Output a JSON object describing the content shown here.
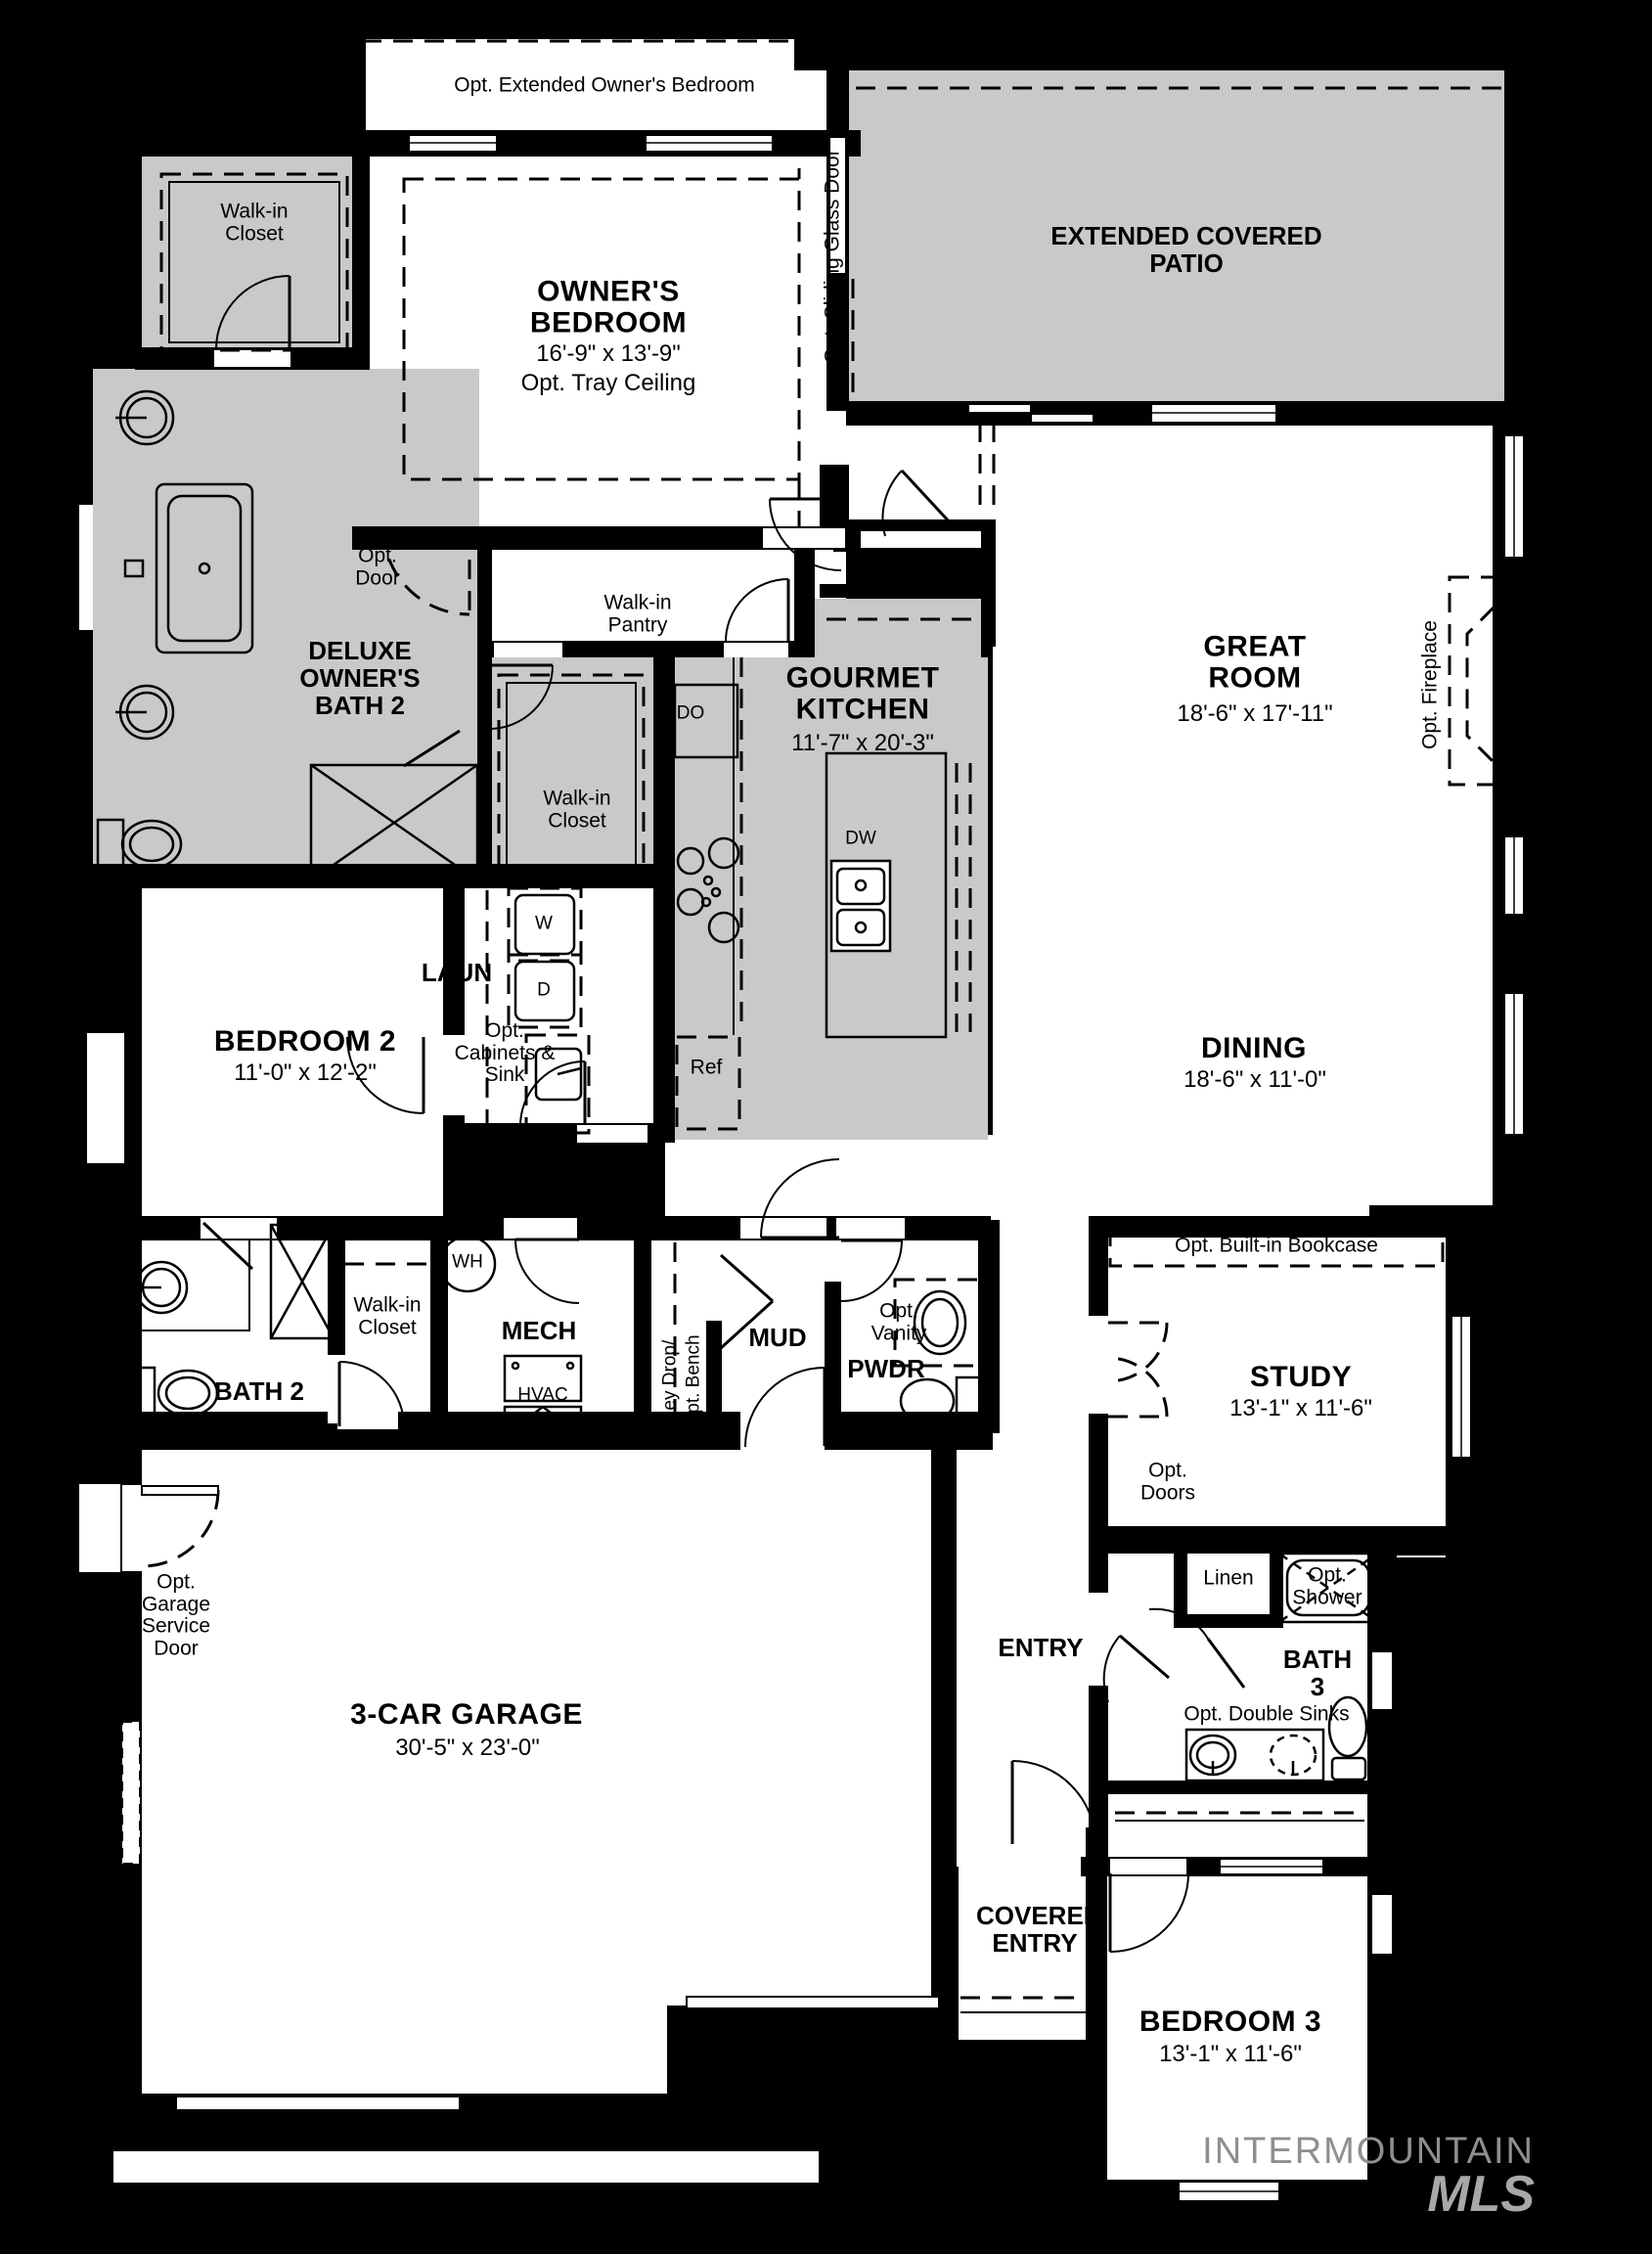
{
  "colors": {
    "background": "#000000",
    "floor": "#ffffff",
    "shaded": "#c9c9c9",
    "wall": "#000000",
    "watermark_gray": "#9b9b9b"
  },
  "rooms": {
    "opt_extended_owners_bedroom": {
      "label": "Opt. Extended Owner's Bedroom"
    },
    "walk_in_closet_owner": {
      "label": "Walk-in Closet"
    },
    "owners_bedroom": {
      "name": "OWNER'S BEDROOM",
      "dims": "16'-9\" x 13'-9\"",
      "note": "Opt. Tray Ceiling"
    },
    "opt_sliding_glass_door": {
      "label": "Opt. Sliding Glass Door"
    },
    "extended_covered_patio": {
      "name": "EXTENDED COVERED PATIO"
    },
    "deluxe_owners_bath": {
      "name": "DELUXE OWNER'S BATH 2"
    },
    "opt_door": {
      "label": "Opt. Door"
    },
    "walk_in_pantry": {
      "label": "Walk-in Pantry"
    },
    "linen_hall": {
      "label": "Linen"
    },
    "gourmet_kitchen": {
      "name": "GOURMET KITCHEN",
      "dims": "11'-7\" x 20'-3\""
    },
    "great_room": {
      "name": "GREAT ROOM",
      "dims": "18'-6\" x 17'-11\""
    },
    "opt_fireplace": {
      "label": "Opt. Fireplace"
    },
    "walk_in_closet_2": {
      "label": "Walk-in Closet"
    },
    "bedroom_2": {
      "name": "BEDROOM 2",
      "dims": "11'-0\" x 12'-2\""
    },
    "laundry": {
      "name": "LAUN"
    },
    "opt_cabinets_sink": {
      "label": "Opt. Cabinets & Sink"
    },
    "dining": {
      "name": "DINING",
      "dims": "18'-6\" x 11'-0\""
    },
    "bath_2": {
      "name": "BATH 2"
    },
    "walk_in_closet_3": {
      "label": "Walk-in Closet"
    },
    "mech": {
      "name": "MECH"
    },
    "key_drop": {
      "line1": "Key Drop/",
      "line2": "Opt. Bench"
    },
    "mud": {
      "name": "MUD"
    },
    "opt_vanity": {
      "label": "Opt. Vanity"
    },
    "pwdr": {
      "name": "PWDR"
    },
    "opt_builtin_bookcase": {
      "label": "Opt. Built-in Bookcase"
    },
    "study": {
      "name": "STUDY",
      "dims": "13'-1\" x 11'-6\""
    },
    "opt_doors": {
      "label": "Opt. Doors"
    },
    "opt_garage_service_door": {
      "label": "Opt. Garage Service Door"
    },
    "garage": {
      "name": "3-CAR GARAGE",
      "dims": "30'-5\" x 23'-0\""
    },
    "entry": {
      "name": "ENTRY"
    },
    "linen_bath3": {
      "label": "Linen"
    },
    "opt_shower": {
      "label": "Opt. Shower"
    },
    "bath_3": {
      "name": "BATH 3"
    },
    "opt_double_sinks": {
      "label": "Opt. Double Sinks"
    },
    "covered_entry": {
      "name": "COVERED ENTRY"
    },
    "bedroom_3": {
      "name": "BEDROOM 3",
      "dims": "13'-1\" x 11'-6\""
    }
  },
  "fixtures": {
    "double_oven": "DO",
    "washer": "W",
    "dryer": "D",
    "dishwasher": "DW",
    "refrigerator": "Ref",
    "water_heater": "WH",
    "hvac": "HVAC"
  },
  "watermark": {
    "line1": "INTERMOUNTAIN",
    "line2": "MLS"
  }
}
